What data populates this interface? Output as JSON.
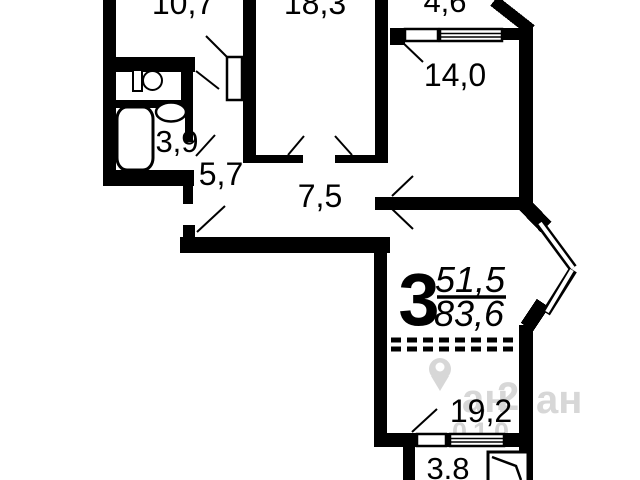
{
  "app": {
    "type": "apartment-floor-plan",
    "description": "3-room apartment floor plan with room areas in square meters"
  },
  "plan": {
    "room_labels": {
      "kitchen": "10,7",
      "living_room": "18,3",
      "loggia_top": "4,6",
      "bedroom": "14,0",
      "bathroom": "3,9",
      "hall_small": "5,7",
      "hall": "7,5",
      "room_large": "19,2",
      "loggia_bottom": "3.8"
    },
    "summary": {
      "rooms_count": "3",
      "living_area": "51,5",
      "total_area": "83,6"
    },
    "watermark": {
      "fragment_left": "ан",
      "fragment_digit": "2",
      "fragment_right": "ан",
      "fragment_numbers": "010"
    },
    "colors": {
      "wall": "#000000",
      "background": "#ffffff",
      "watermark": "#d7d7d7"
    }
  }
}
